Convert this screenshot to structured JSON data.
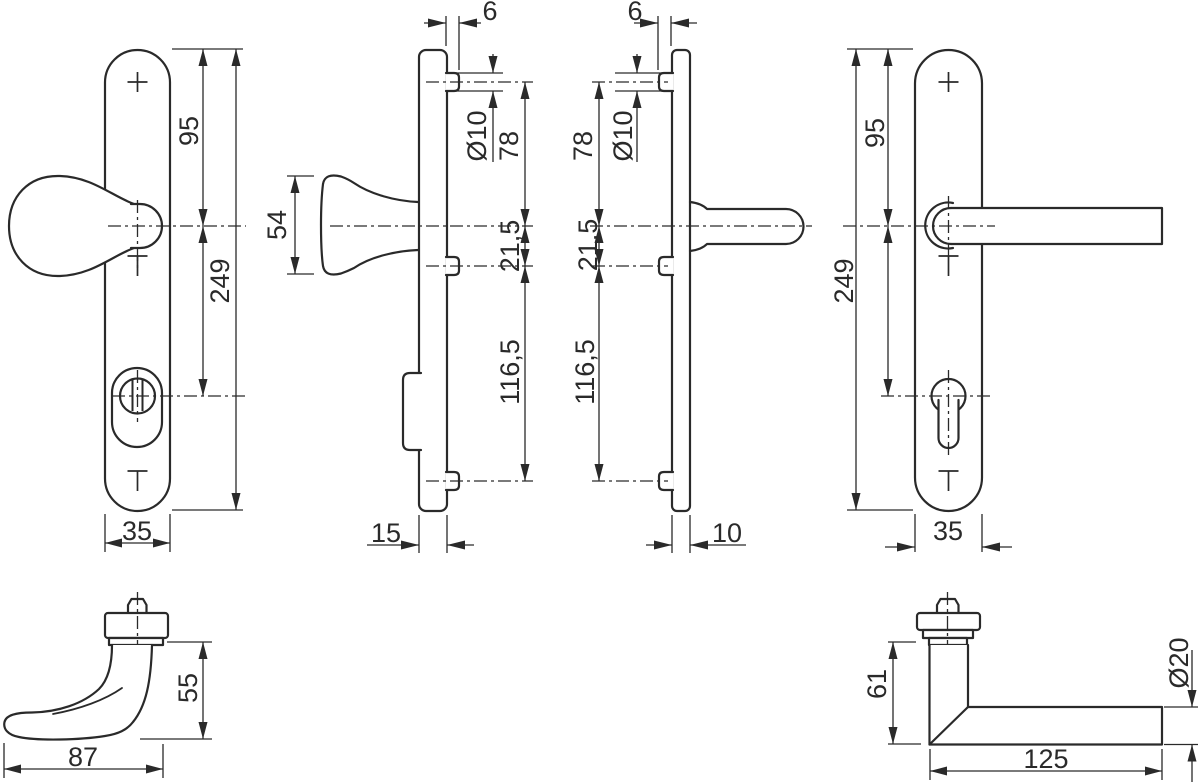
{
  "drawing": {
    "type": "technical-dimension-drawing",
    "subject": "security door handle set (backplates with knob and lever)",
    "colors": {
      "line": "#2a2a2a",
      "background": "#ffffff"
    },
    "views": {
      "exterior_front": {
        "dims": {
          "hole_spacing": "95",
          "length": "249",
          "width": "35"
        }
      },
      "exterior_side": {
        "dims": {
          "knob_height": "54",
          "screw_offset": "6",
          "pin_diameter": "Ø10",
          "upper_spacing": "78",
          "center_spacing": "21,5",
          "lower_spacing": "116,5",
          "depth": "15"
        }
      },
      "interior_side": {
        "dims": {
          "screw_offset": "6",
          "pin_diameter": "Ø10",
          "upper_spacing": "78",
          "center_spacing": "21,5",
          "lower_spacing": "116,5",
          "depth": "10"
        }
      },
      "interior_front": {
        "dims": {
          "hole_spacing": "95",
          "length": "249",
          "width": "35"
        }
      },
      "knob_detail": {
        "dims": {
          "height": "55",
          "length": "87"
        }
      },
      "lever_detail": {
        "dims": {
          "height": "61",
          "length": "125",
          "grip_diameter": "Ø20"
        }
      }
    }
  }
}
